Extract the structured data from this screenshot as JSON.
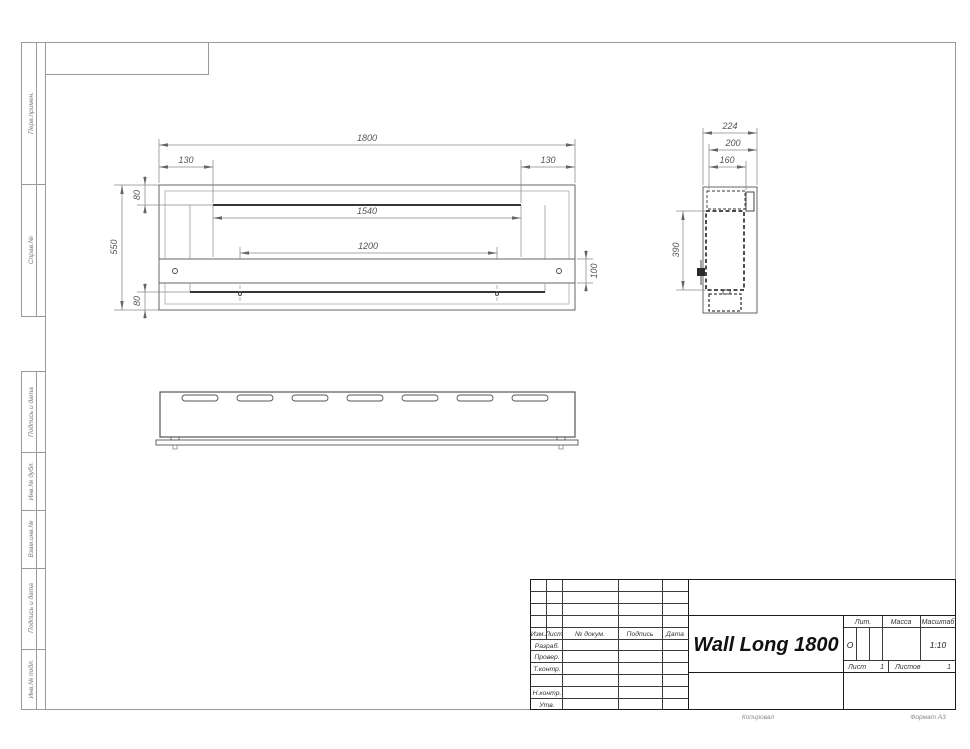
{
  "sheet": {
    "copied": "Копировал",
    "format": "Формат А3"
  },
  "sidebar": {
    "items": [
      {
        "label": "Перв.примен."
      },
      {
        "label": "Справ.№"
      },
      {
        "label": "Подпись и дата"
      },
      {
        "label": "Инв.№ дубл."
      },
      {
        "label": "Взам.инв.№"
      },
      {
        "label": "Подпись и дата"
      },
      {
        "label": "Инв.№ подл."
      }
    ]
  },
  "title_block": {
    "title": "Wall Long 1800",
    "columns": {
      "izm": "Изм.",
      "list": "Лист",
      "doc": "№ докум.",
      "sign": "Подпись",
      "date": "Дата"
    },
    "roles": {
      "developed": "Разраб.",
      "checked": "Провер.",
      "tcontrol": "Т.контр.",
      "ncontrol": "Н.контр.",
      "approved": "Утв."
    },
    "lit": {
      "label": "Лит.",
      "value": "О"
    },
    "mass": {
      "label": "Масса",
      "value": ""
    },
    "scale": {
      "label": "Масштаб",
      "value": "1:10"
    },
    "sheet_no": {
      "label": "Лист",
      "value": "1"
    },
    "sheets_total": {
      "label": "Листов",
      "value": "1"
    }
  },
  "views": {
    "front": {
      "dims": {
        "overall_width": "1800",
        "left_offset": "130",
        "right_offset": "130",
        "top_flange": "80",
        "overall_height": "550",
        "bottom_flange": "80",
        "opening_width": "1540",
        "mount_span": "1200",
        "bracket_height": "100"
      }
    },
    "side": {
      "dims": {
        "overall_depth": "224",
        "inner_depth": "200",
        "body_depth": "160",
        "body_height": "390"
      }
    }
  }
}
